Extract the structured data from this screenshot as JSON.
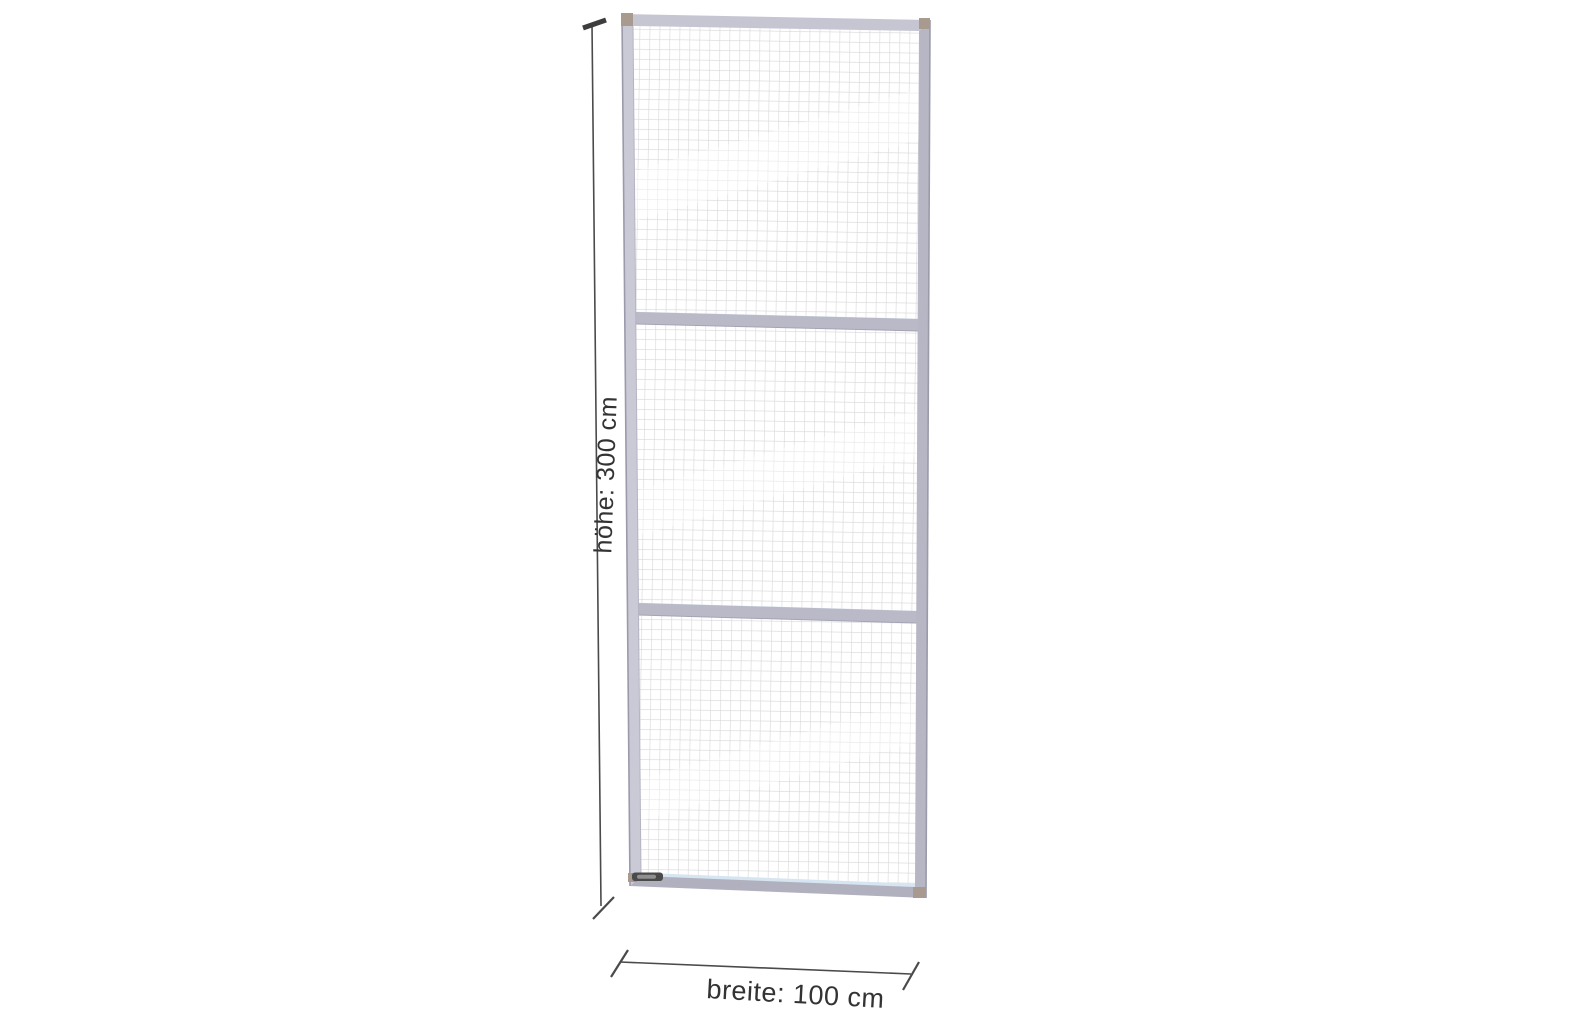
{
  "page": {
    "background_color": "#ffffff"
  },
  "diagram": {
    "type": "technical-drawing",
    "subject": "wire-mesh-partition-panel",
    "panel": {
      "mesh_sections": 3,
      "colors": {
        "frame": "#c6c6d3",
        "frame_left": "#cacad7",
        "frame_right": "#b6b6c4",
        "frame_bottom": "#b0b0bf",
        "frame_edge": "#9a9aab",
        "crossbar": "#b9b9c7",
        "crossbar_highlight": "#d6e5f2",
        "mesh_line": "#d7d7da",
        "corner_cap": "#a89a8e",
        "tag": "#4a4a4a",
        "tag_inner": "#909090"
      }
    },
    "annotations": {
      "height": {
        "label": "höhe: 300 cm"
      },
      "width": {
        "label": "breite: 100 cm"
      },
      "line_color": "#4a4a4a",
      "text_color": "#333333"
    }
  }
}
